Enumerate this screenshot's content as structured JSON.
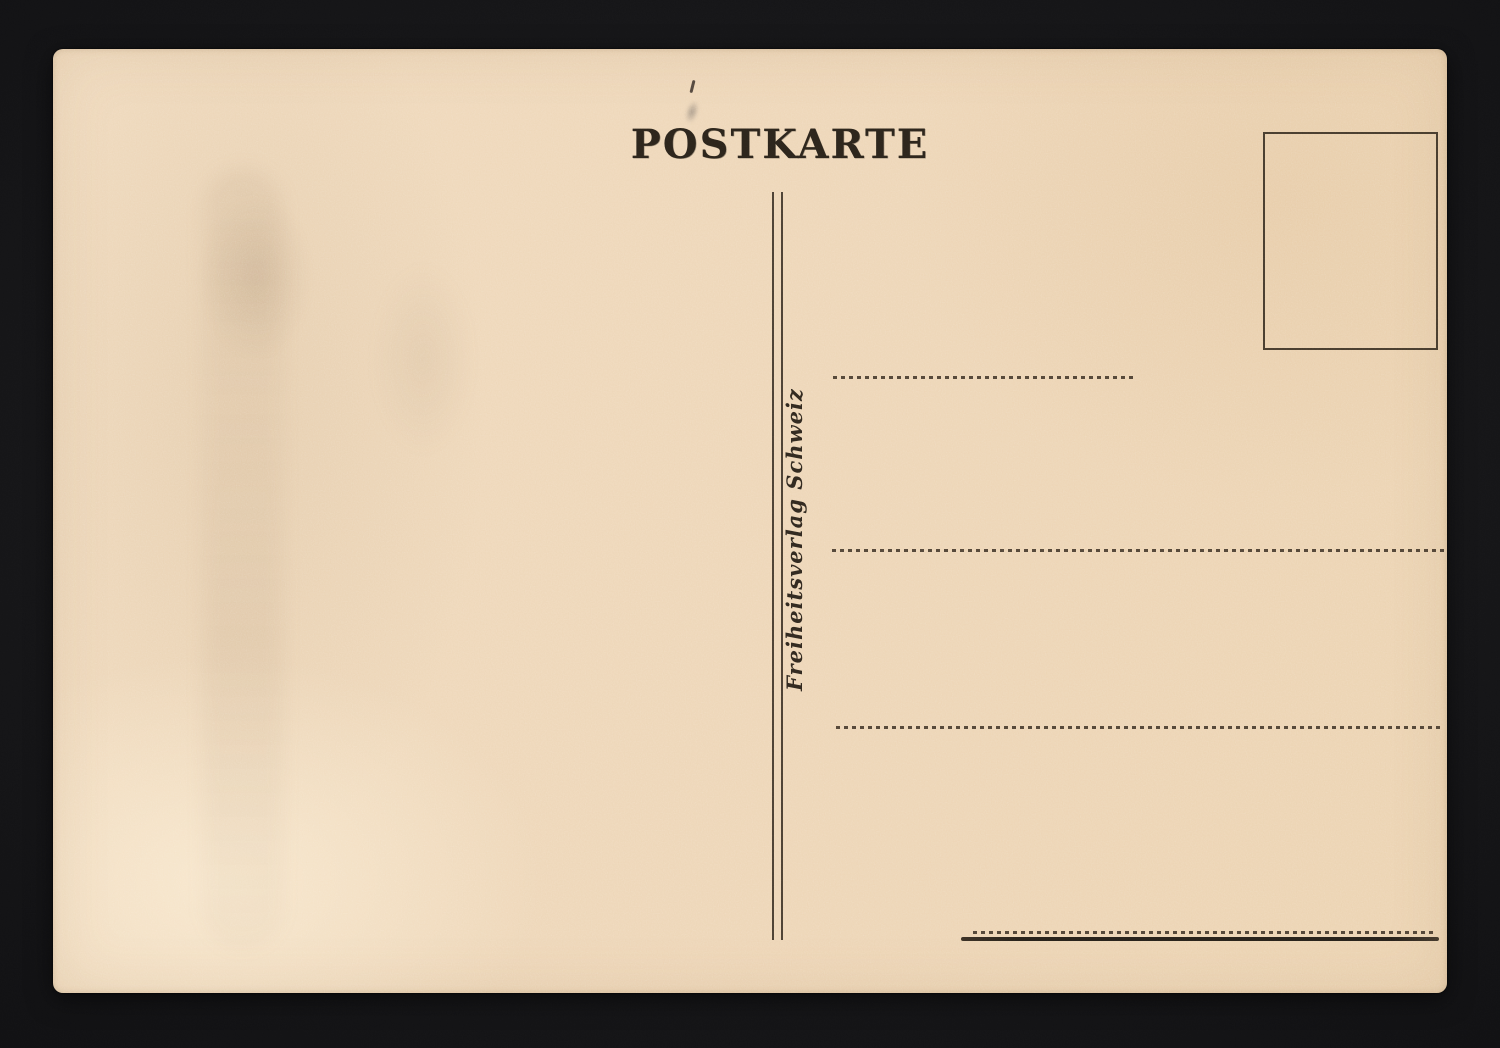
{
  "postcard": {
    "title": "POSTKARTE",
    "publisher_imprint": "Freiheitsverlag Schweiz",
    "stamp_box_content": "",
    "address_lines": [
      "",
      "",
      ""
    ],
    "signature_line": "",
    "colors": {
      "paper": "#EED7B8",
      "ink": "#2B241C",
      "rule": "#362C21",
      "scanner_background": "#151517"
    }
  }
}
